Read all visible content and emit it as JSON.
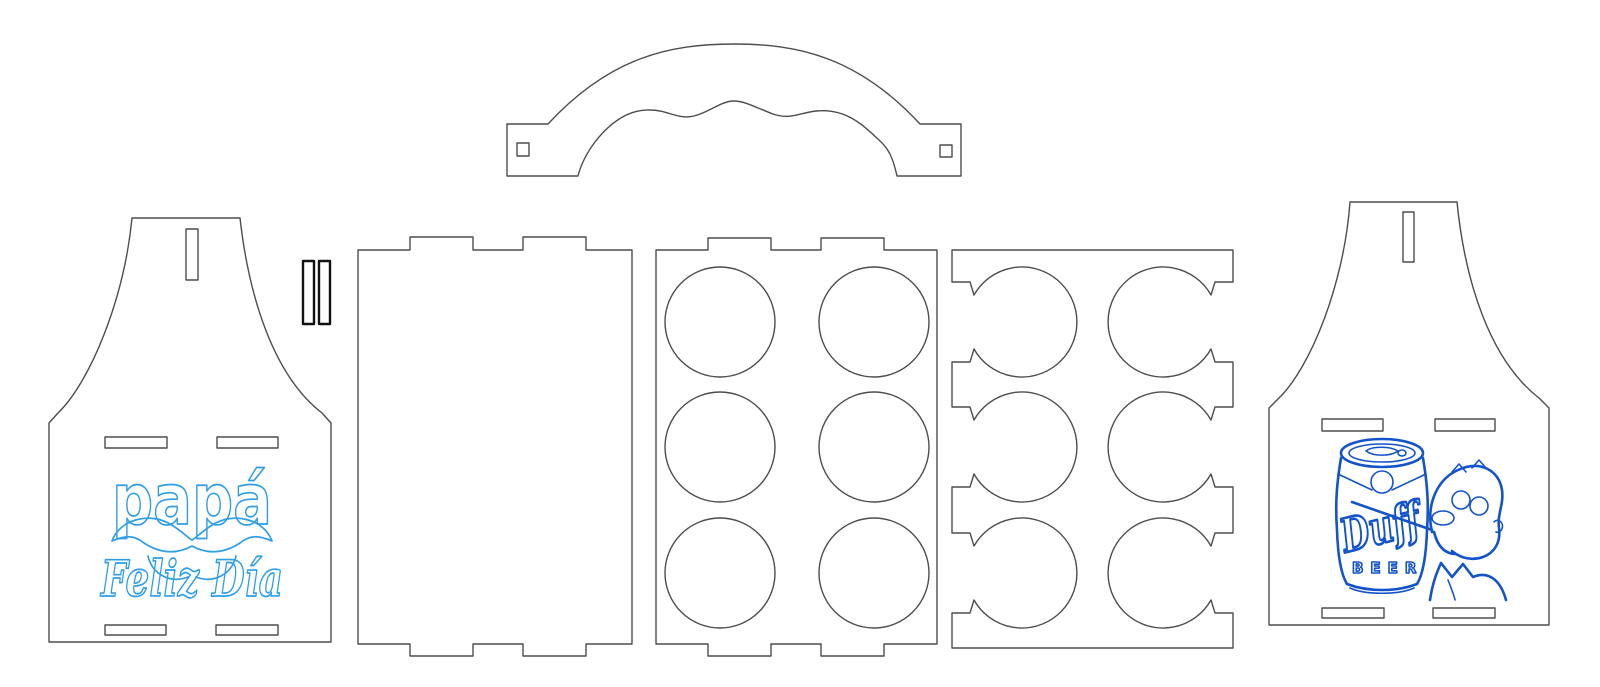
{
  "canvas": {
    "width": 1600,
    "height": 687,
    "background_color": "#ffffff",
    "cut_line_color": "#4d4d4d",
    "pin_line_color": "#111111"
  },
  "design": {
    "name": "six-pack-caddy-laser-template",
    "pieces": [
      {
        "id": "handle",
        "label": "carry handle with two square pin holes"
      },
      {
        "id": "front-panel",
        "label": "apron end panel with papa engraving, 1 vertical slot, 4 horizontal slots"
      },
      {
        "id": "pins",
        "label": "two narrow locking pins",
        "count": 2
      },
      {
        "id": "side-panel",
        "label": "plain side wall with finger tabs top and bottom"
      },
      {
        "id": "bottle-tray",
        "label": "tray with 6 round bottle holes",
        "hole_count": 6
      },
      {
        "id": "bottle-divider",
        "label": "divider with 6 side-open bottle holes",
        "hole_count": 6
      },
      {
        "id": "back-panel",
        "label": "apron end panel with Duff beer engraving, 1 vertical slot, 4 horizontal slots"
      }
    ]
  },
  "engravings": {
    "front": {
      "word": "papá",
      "subtitle": "Feliz Día",
      "color": "#2f9ee8",
      "motif": "bubble letters with mustache"
    },
    "back": {
      "brand": "Duff",
      "brand_sub": "BEER",
      "color": "#1353cb",
      "motif": "beer can with Homer drinking"
    }
  }
}
